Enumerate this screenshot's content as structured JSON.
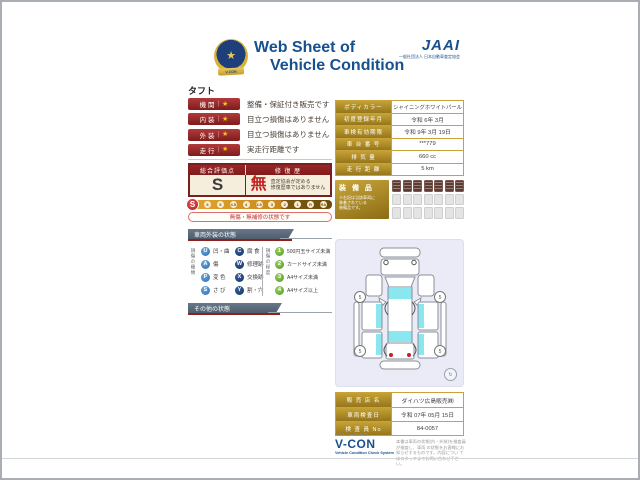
{
  "header": {
    "title_line1": "Web Sheet of",
    "title_line2": "Vehicle Condition",
    "badge_ribbon": "V-CON",
    "jaai": "JAAI",
    "jaai_subtext": "一般社団法人 日本自動車査定協会"
  },
  "vehicle_name": "タフト",
  "ratings": [
    {
      "label": "機 関",
      "star": "★",
      "text": "整備・保証付き販売です"
    },
    {
      "label": "内 装",
      "star": "★",
      "text": "目立つ損傷はありません"
    },
    {
      "label": "外 装",
      "star": "★",
      "text": "目立つ損傷はありません"
    },
    {
      "label": "走 行",
      "star": "★",
      "text": "実走行距離です"
    }
  ],
  "evaluation": {
    "score_header": "総合評価点",
    "repair_header": "修 復 歴",
    "score": "S",
    "repair_value": "無",
    "repair_note_line1": "査定協会が定める",
    "repair_note_line2": "修復歴車ではありません",
    "scale_current": "S",
    "scale": [
      "6",
      "5",
      "4.5",
      "4",
      "3.5",
      "3",
      "2",
      "1",
      "R",
      "RA"
    ],
    "condition_note": "無傷・無補修の状態です"
  },
  "sections": {
    "exterior": "車両外装の状態",
    "other": "その他の状態"
  },
  "legend": {
    "type_label": "損傷の種類",
    "degree_label": "損傷の程度",
    "types_col1": [
      {
        "code": "U",
        "label": "凹・曲"
      },
      {
        "code": "A",
        "label": "傷"
      },
      {
        "code": "P",
        "label": "変 色"
      },
      {
        "code": "S",
        "label": "さ び"
      }
    ],
    "types_col2": [
      {
        "code": "C",
        "label": "腐 食"
      },
      {
        "code": "W",
        "label": "修理跡"
      },
      {
        "code": "X",
        "label": "交換跡"
      },
      {
        "code": "Y",
        "label": "割・穴"
      }
    ],
    "degrees": [
      {
        "code": "1",
        "label": "500円玉サイズ未満"
      },
      {
        "code": "2",
        "label": "カードサイズ未満"
      },
      {
        "code": "3",
        "label": "A4サイズ未満"
      },
      {
        "code": "4",
        "label": "A4サイズ以上"
      }
    ]
  },
  "vehicle_info": {
    "rows": [
      {
        "label": "ボディカラー",
        "value": "シャイニングホワイトパール"
      },
      {
        "label": "初度登録年月",
        "value": "令和 6年 3月"
      },
      {
        "label": "車検有効期限",
        "value": "令和 9年 3月 19日"
      },
      {
        "label": "車 台 番 号",
        "value": "***779"
      },
      {
        "label": "排 気 量",
        "value": "660 cc"
      },
      {
        "label": "走 行 距 離",
        "value": "5 km"
      }
    ]
  },
  "equipment": {
    "label": "装 備 品",
    "note_lines": [
      "※右記は当該車両に",
      "装着されている",
      "装備品です。"
    ],
    "filled_badges": 7,
    "empty_badges": 14
  },
  "diagram": {
    "wheel_marks": [
      "5",
      "5",
      "5",
      "5"
    ]
  },
  "dealer": {
    "rows": [
      {
        "label": "販 売 店 名",
        "value": "ダイハツ広島販売㈱"
      },
      {
        "label": "車両検査日",
        "value": "令和 07年 05月 15日"
      },
      {
        "label": "検 査 員 No",
        "value": "84-0057"
      }
    ]
  },
  "footer": {
    "doc_number": "N64021-000069",
    "vcon": "V-CON",
    "vcon_sub": "Vehicle Condition Check System",
    "disclaimer_lines": [
      "本書は車両の状態(内・外装)を検査員が検査し、車両",
      "の状態をお客様にお知らせするものです。内容につい",
      "てはスタッフまでお問い合わせ下さい。"
    ]
  },
  "colors": {
    "accent_red": "#8e2020",
    "gold": "#b08a28",
    "brand_blue": "#17508e",
    "window_cyan": "#8ae6ef"
  }
}
